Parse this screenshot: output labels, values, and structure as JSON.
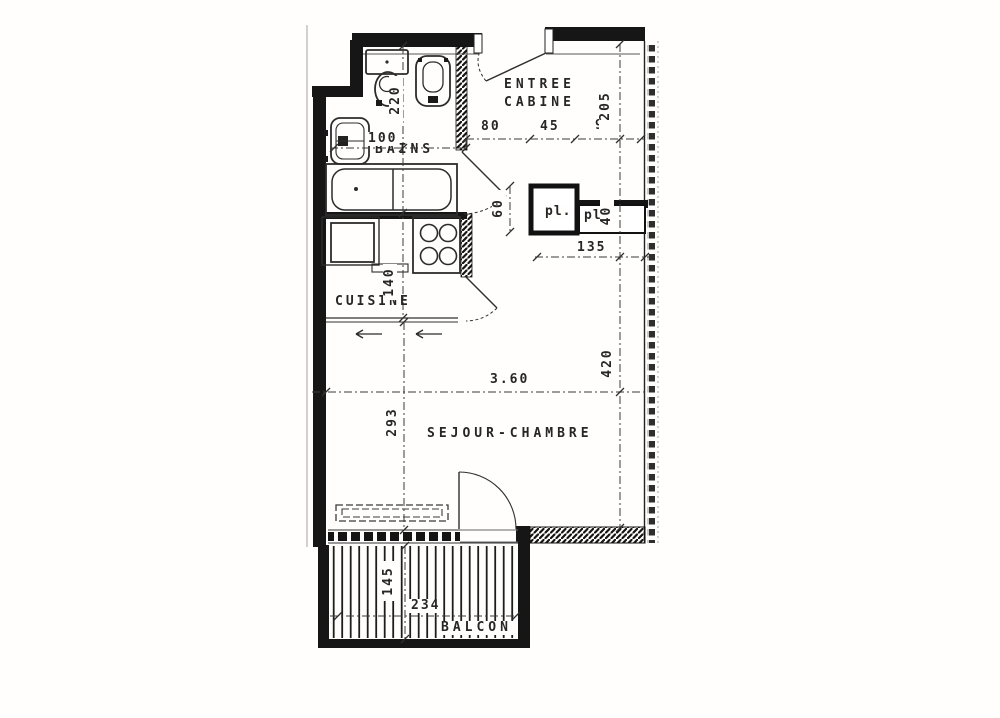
{
  "colors": {
    "ink": "#262626",
    "paper": "#fffefd",
    "wall": "#161616"
  },
  "rooms": {
    "entree_line1": "ENTREE",
    "entree_line2": "CABINE",
    "bains": "BAINS",
    "cuisine": "CUISINE",
    "sejour": "SEJOUR-CHAMBRE",
    "balcon": "BALCON",
    "closet1": "pl.",
    "closet2": "pl."
  },
  "dimensions": {
    "bains_width": "100",
    "entree_seg1": "80",
    "entree_seg2": "45",
    "entree_seg3": "90",
    "wc_depth": "220",
    "cabine_depth": "205",
    "closet_depth": "60",
    "closet2_depth": "40",
    "closet_width": "135",
    "cuisine_depth": "140",
    "sejour_width_m": "3.60",
    "sejour_depth": "293",
    "sejour_length": "420",
    "balcon_depth": "145",
    "balcon_width": "234"
  }
}
